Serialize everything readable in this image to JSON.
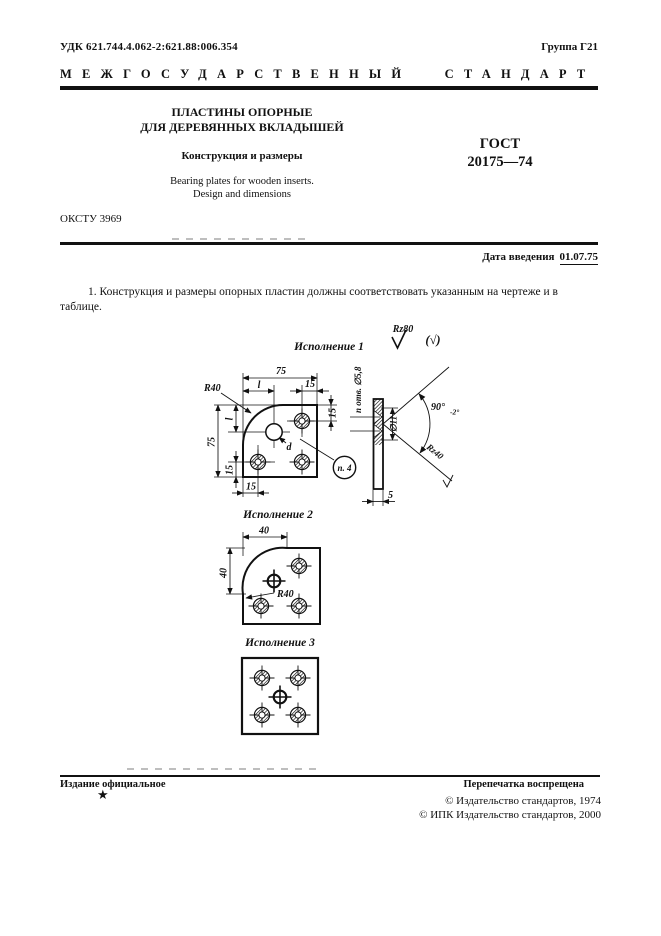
{
  "header": {
    "udk": "УДК 621.744.4.062-2:621.88:006.354",
    "group": "Группа Г21",
    "standard_kind": "МЕЖГОСУДАРСТВЕННЫЙ СТАНДАРТ"
  },
  "title_block": {
    "title_ru_line1": "ПЛАСТИНЫ ОПОРНЫЕ",
    "title_ru_line2": "ДЛЯ ДЕРЕВЯННЫХ ВКЛАДЫШЕЙ",
    "subtitle": "Конструкция и размеры",
    "title_en_line1": "Bearing plates for wooden inserts.",
    "title_en_line2": "Design and dimensions",
    "gost_label": "ГОСТ",
    "gost_number": "20175—74",
    "okstu": "ОКСТУ 3969"
  },
  "effective": {
    "label": "Дата введения",
    "date": "01.07.75"
  },
  "body": {
    "clause1": "1. Конструкция и размеры опорных пластин должны соответствовать указанным на чертеже и в таблице."
  },
  "drawing": {
    "roughness": {
      "main": "Rz80",
      "alt": "(√)"
    },
    "variant1": {
      "label": "Исполнение 1",
      "dim_width_75": "75",
      "dim_l_top": "l",
      "dim_15_top": "15",
      "dim_15_right": "15",
      "dim_height_75": "75",
      "dim_l_left": "l",
      "dim_15_left": "15",
      "dim_15_bottom": "15",
      "radius_r40": "R40",
      "hole_diameter_d": "d",
      "callout": "п. 4"
    },
    "side": {
      "holes_note": "n отв. ∅5,8",
      "countersink_dia": "∅11",
      "angle": "90°",
      "angle_tolerance": "-2°",
      "chamfer_roughness": "Rz40",
      "thickness": "5"
    },
    "variant2": {
      "label": "Исполнение 2",
      "dim_width_40": "40",
      "dim_height_40": "40",
      "radius_r40": "R40"
    },
    "variant3": {
      "label": "Исполнение 3"
    }
  },
  "footer": {
    "official": "Издание официальное",
    "reprint": "Перепечатка воспрещена",
    "star": "★",
    "copyright_1974": "©  Издательство стандартов, 1974",
    "copyright_2000": "©  ИПК Издательство стандартов, 2000"
  }
}
